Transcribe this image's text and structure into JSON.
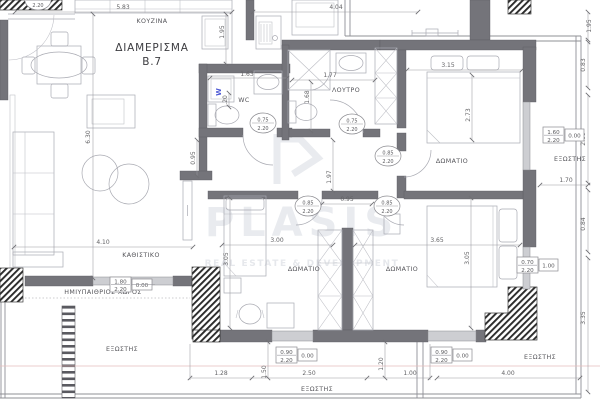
{
  "watermark": {
    "logo": "P",
    "brand": "PLASIS",
    "tagline": "REAL ESTATE & DEVELOPMENT"
  },
  "title": {
    "line1": "ΔΙΑΜΕΡΙΣΜΑ",
    "line2": "B.7"
  },
  "rooms": {
    "kitchen": "ΚΟΥΖΙΝΑ",
    "bathroom": "ΛΟΥΤΡΟ",
    "wc": "WC",
    "bedroom": "ΔΩΜΑΤΙΟ",
    "living": "ΚΑΘΙΣΤΙΚΟ",
    "balcony": "ΕΞΩΣΤΗΣ",
    "semi_open_space": "ΗΜΙΥΠΑΙΘΡΙΟΣ ΧΩΡΟΣ"
  },
  "appliances": {
    "washer_label": "W"
  },
  "dims": {
    "d_583": "5.83",
    "d_404": "4.04",
    "d_195_kitchen": "1.95",
    "d_195_balc": "1.95",
    "d_163": "1.63",
    "d_020": ".20",
    "d_177": "1.77",
    "d_168": "1.68",
    "d_095_hall_v": "0.95",
    "d_095_hall_h": "0.95",
    "d_197": "1.97",
    "d_630": "6.30",
    "d_410": "4.10",
    "d_315": "3.15",
    "d_273": "2.73",
    "d_083": "0.83",
    "d_260": "2.60",
    "d_170": "1.70",
    "d_084": "0.84",
    "d_335": "3.35",
    "d_300": "3.00",
    "d_305_l": "3.05",
    "d_305_r": "3.05",
    "d_365": "3.65",
    "d_128": "1.28",
    "d_250": "2.50",
    "d_100": "1.00",
    "d_400": "4.00",
    "d_150": "1.50",
    "d_120": "1.20"
  },
  "door_labels": [
    {
      "height": "2.20"
    },
    {
      "width": "0.75",
      "height": "2.20"
    },
    {
      "width": "0.75",
      "height": "2.20"
    },
    {
      "width": "0.85",
      "height": "2.20"
    },
    {
      "width": "0.85",
      "height": "2.20"
    },
    {
      "width": "0.85",
      "height": "2.20"
    }
  ],
  "window_labels": [
    {
      "width": "1.80",
      "height": "2.20",
      "sill": "0.00"
    },
    {
      "width": "1.60",
      "height": "2.20",
      "sill": "0.00"
    },
    {
      "width": "0.70",
      "height": "2.20",
      "sill": "1.00"
    },
    {
      "width": "0.90",
      "height": "2.20",
      "sill": "0.00"
    },
    {
      "width": "0.90",
      "height": "2.20",
      "sill": "0.00"
    }
  ],
  "colors": {
    "wall": "#74747a",
    "washer_accent": "#4f5bd5",
    "section_line": "#e5bcbc",
    "watermark": "#e9ebef"
  }
}
